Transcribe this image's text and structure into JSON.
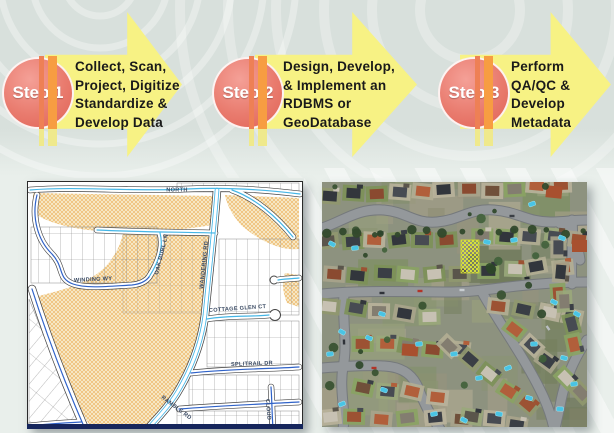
{
  "steps": [
    {
      "label": "Step 1",
      "lines": [
        "Collect, Scan,",
        "Project, Digitize",
        "Standardize &",
        "Develop Data"
      ]
    },
    {
      "label": "Step 2",
      "lines": [
        "Design, Develop,",
        "& Implement an",
        "RDBMS or",
        "GeoDatabase"
      ]
    },
    {
      "label": "Step 3",
      "lines": [
        "Perform",
        "QA/QC &",
        "Develop",
        "Metadata"
      ]
    }
  ],
  "colors": {
    "arrow_fill": "#f7f284",
    "arrow_text": "#1a1a1a",
    "circle_fill": "#e97b6e",
    "circle_text": "#ffffff",
    "stripe_left": "#ee8055",
    "stripe_right": "#f79d42",
    "stripe_stub": "#efe98c",
    "bg_top": "#d8e0dc",
    "bg_bottom": "#e9efeb"
  },
  "map": {
    "name": "parcel-map",
    "labels": {
      "north": "NORTH",
      "winding": "WINDING WY",
      "oak_burl": "OAK BURL LN",
      "wandering": "WANDERING RD",
      "cottage_glen": "COTTAGE GLEN CT",
      "splitrail": "SPLITRAIL DR",
      "ramble": "RAMBLE RD",
      "cloud": "CLOUD"
    }
  },
  "aerial": {
    "name": "aerial-photo-neighborhood"
  }
}
